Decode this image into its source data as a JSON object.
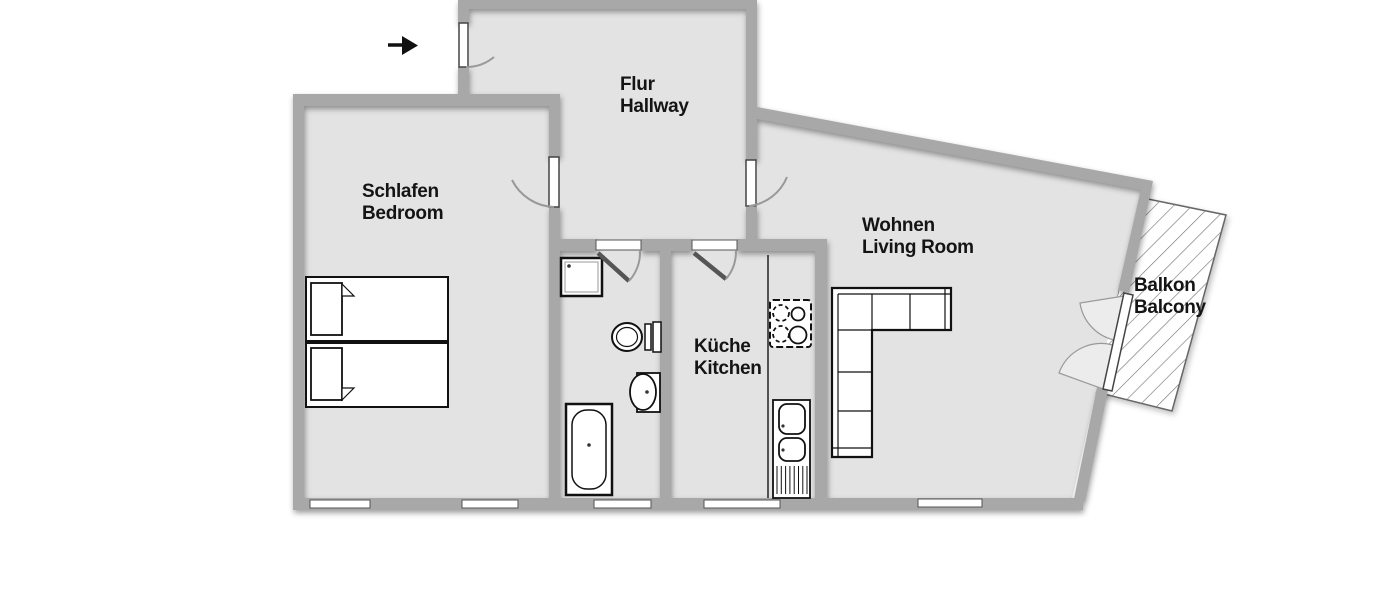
{
  "floorplan": {
    "type": "apartment-floor-plan",
    "rooms": [
      {
        "key": "bedroom",
        "name_de": "Schlafen",
        "name_en": "Bedroom"
      },
      {
        "key": "hallway",
        "name_de": "Flur",
        "name_en": "Hallway"
      },
      {
        "key": "living-room",
        "name_de": "Wohnen",
        "name_en": "Living Room"
      },
      {
        "key": "kitchen",
        "name_de": "Küche",
        "name_en": "Kitchen"
      },
      {
        "key": "balcony",
        "name_de": "Balkon",
        "name_en": "Balcony"
      }
    ],
    "fixtures": {
      "bedroom": [
        "double-bed"
      ],
      "bathroom": [
        "shower",
        "toilet",
        "wash-basin",
        "bathtub"
      ],
      "kitchen": [
        "counter",
        "stove",
        "sink-unit"
      ],
      "living_room": [
        "corner-sofa"
      ],
      "entrance": [
        "entrance-arrow"
      ]
    },
    "colors": {
      "background": "#ffffff",
      "wall": "#a8a8a8",
      "floor": "#e3e3e3",
      "furniture_outline": "#111111",
      "door_arc": "#999999",
      "hatch": "#777777",
      "text": "#141414"
    }
  }
}
